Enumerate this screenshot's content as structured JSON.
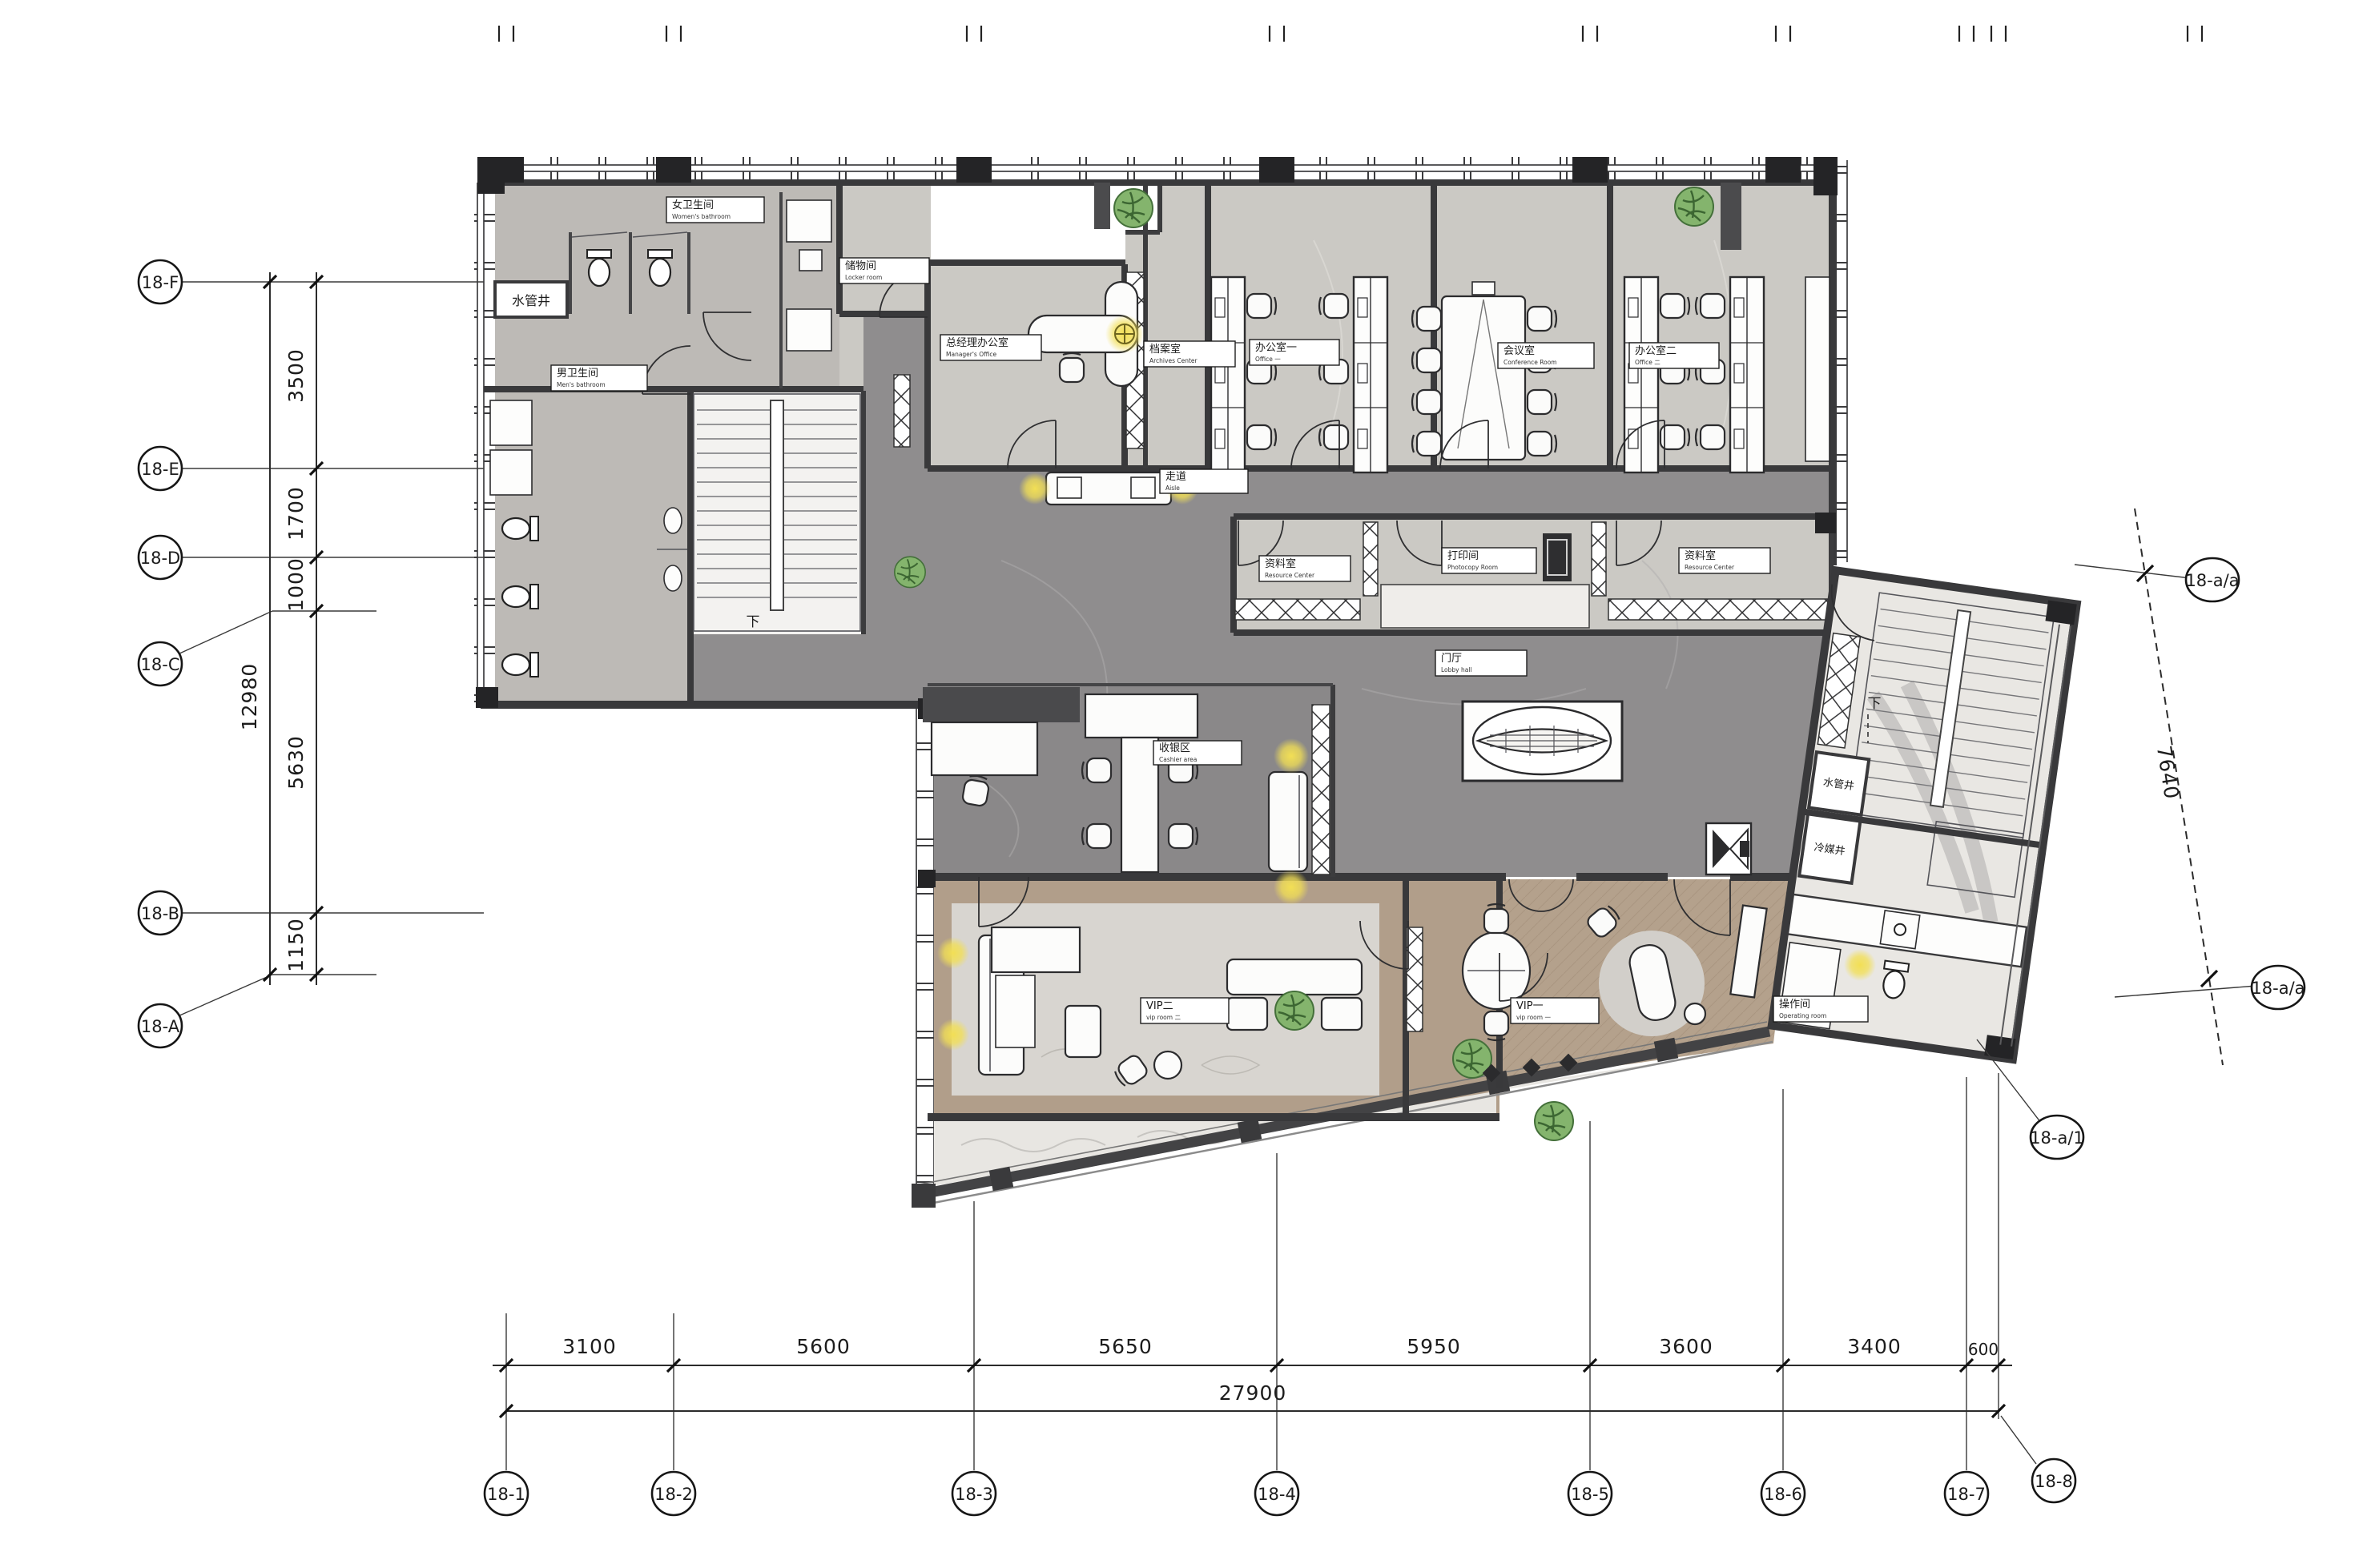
{
  "drawing": {
    "grid": {
      "left": {
        "bubbles": [
          "18-F",
          "18-E",
          "18-D",
          "18-C",
          "18-B",
          "18-A"
        ],
        "segments": [
          "3500",
          "1700",
          "1000",
          "5630",
          "1150"
        ],
        "total": "12980"
      },
      "bottom": {
        "bubbles": [
          "18-1",
          "18-2",
          "18-3",
          "18-4",
          "18-5",
          "18-6",
          "18-7",
          "18-8"
        ],
        "segments": [
          "3100",
          "5600",
          "5650",
          "5950",
          "3600",
          "3400",
          "600"
        ],
        "total": "27900"
      },
      "right": {
        "bubbles": [
          "18-a/a",
          "18-a/a",
          "18-a/1"
        ],
        "segments": [
          "7640"
        ]
      }
    },
    "rooms": {
      "womens_bathroom": {
        "zh": "女卫生间",
        "en": "Women's bathroom"
      },
      "mens_bathroom": {
        "zh": "男卫生间",
        "en": "Men's bathroom"
      },
      "pipe_shaft": {
        "zh": "水管井",
        "en": ""
      },
      "refrigerant_shaft": {
        "zh": "冷媒井",
        "en": ""
      },
      "locker_room": {
        "zh": "储物间",
        "en": "Locker room"
      },
      "managers_office": {
        "zh": "总经理办公室",
        "en": "Manager's Office"
      },
      "archives": {
        "zh": "档案室",
        "en": "Archives Center"
      },
      "office_1": {
        "zh": "办公室一",
        "en": "Office 一"
      },
      "conference": {
        "zh": "会议室",
        "en": "Conference Room"
      },
      "office_2": {
        "zh": "办公室二",
        "en": "Office 二"
      },
      "aisle": {
        "zh": "走道",
        "en": "Aisle"
      },
      "resource_center": {
        "zh": "资料室",
        "en": "Resource Center"
      },
      "photocopy": {
        "zh": "打印间",
        "en": "Photocopy Room"
      },
      "lobby": {
        "zh": "门厅",
        "en": "Lobby hall"
      },
      "cashier": {
        "zh": "收银区",
        "en": "Cashier area"
      },
      "vip_1": {
        "zh": "VIP一",
        "en": "vip room 一"
      },
      "vip_2": {
        "zh": "VIP二",
        "en": "vip room 二"
      },
      "operating": {
        "zh": "操作间",
        "en": "Operating room"
      }
    },
    "marks": {
      "down": "下"
    },
    "colors": {
      "wall": "#39393b",
      "corridor_floor": "#8f8d8e",
      "room_floor": "#cbc9c4",
      "wood_floor": "#b19e8a",
      "vip_floor": "#d8d5d0",
      "accent_light": "#f2df55",
      "plant_green": "#84b46d",
      "label_ink": "#1e1e1e"
    }
  }
}
